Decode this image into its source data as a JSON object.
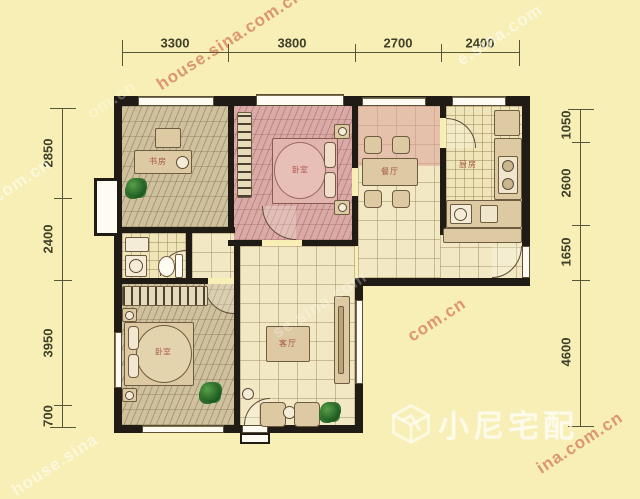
{
  "dimensions": {
    "top": [
      "3300",
      "3800",
      "2700",
      "2400"
    ],
    "left": [
      "2850",
      "2400",
      "3950",
      "700"
    ],
    "right": [
      "1050",
      "2600",
      "1650",
      "4600"
    ]
  },
  "rooms": {
    "study": "书房",
    "bedroom_top": "卧室",
    "dining": "餐厅",
    "kitchen": "厨房",
    "living": "客厅",
    "bedroom_bottom": "卧室"
  },
  "logo": {
    "text": "小尼宅配"
  },
  "watermarks": [
    {
      "text": "house.sina.com.cn"
    },
    {
      "text": "e.sina.com"
    },
    {
      "text": "a.com.cn"
    },
    {
      "text": "com.cn"
    },
    {
      "text": "ina.com.cn"
    },
    {
      "text": "house.sina"
    },
    {
      "text": "se.sina.com"
    },
    {
      "text": "om.cn"
    }
  ],
  "colors": {
    "background": "#f7efb5",
    "wall": "#201c15",
    "dimension_text": "#3f3f2a",
    "wood_floor": "#cfc19d",
    "pink_floor": "#d9aaa6",
    "tile_floor": "#f2e8c4",
    "watermark_red": "#c43e28",
    "watermark_white": "#ffffff",
    "room_label": "#9c4136"
  }
}
